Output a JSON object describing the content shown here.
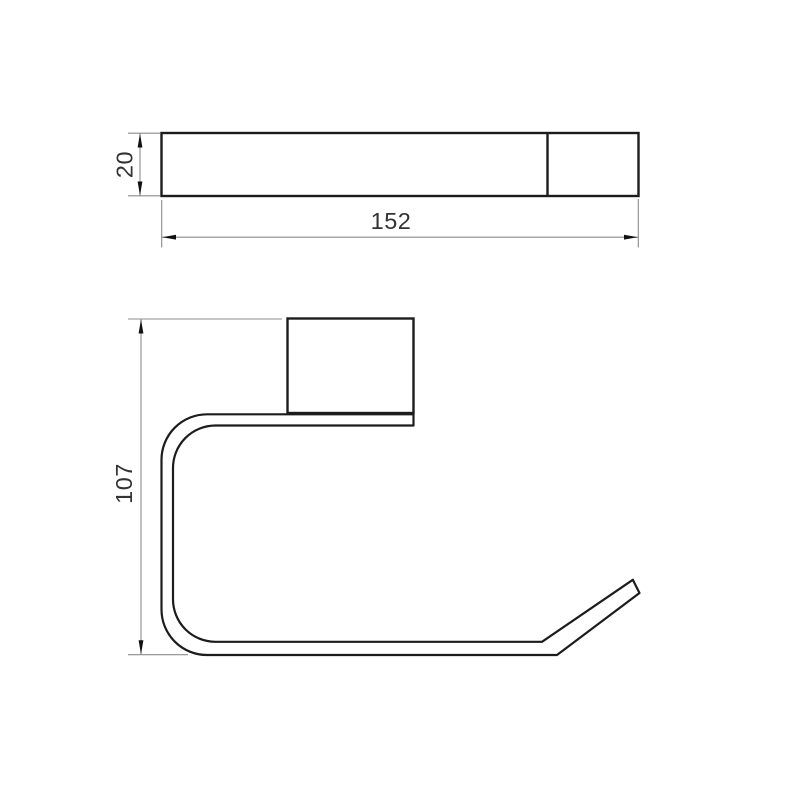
{
  "drawing": {
    "kind": "technical-dimension-diagram",
    "subject": "wall-mounted holder profile drawing",
    "views": {
      "top_view": {
        "label": "top-view",
        "width_dim": "152",
        "height_dim": "20"
      },
      "front_view": {
        "label": "front-profile-view",
        "height_dim": "107"
      }
    },
    "colors": {
      "object_line": "#1c1c1c",
      "dimension_line": "#8c8c8c",
      "arrow": "#111111",
      "text": "#333333",
      "background": "#ffffff"
    }
  }
}
